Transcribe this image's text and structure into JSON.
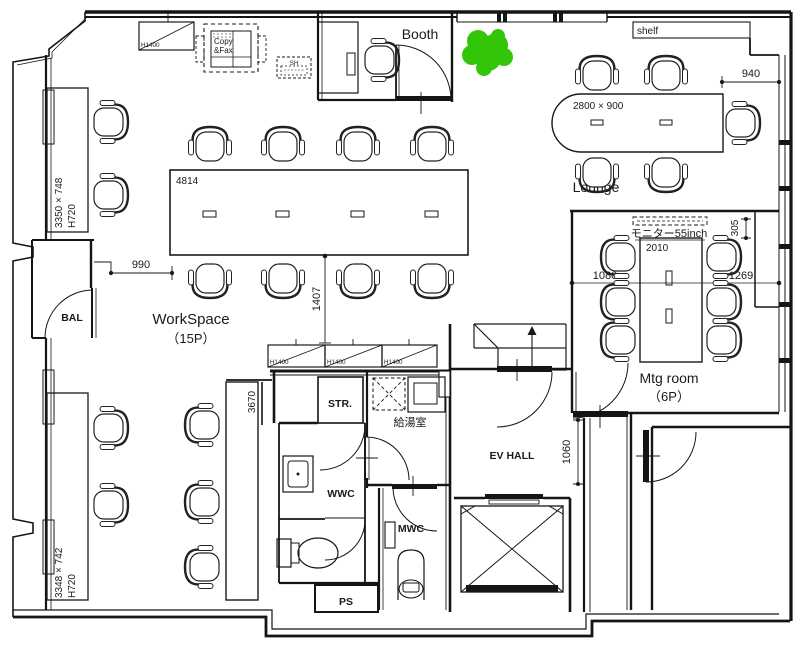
{
  "plan": {
    "rooms": {
      "booth": "Booth",
      "lounge": "Lounge",
      "workspace_line1": "WorkSpace",
      "workspace_line2": "（15P）",
      "mtg_line1": "Mtg room",
      "mtg_line2": "（6P）",
      "bal": "BAL",
      "str": "STR.",
      "kitchen": "給湯室",
      "wwc": "WWC",
      "mwc": "MWC",
      "ps": "PS",
      "ev_hall": "EV HALL"
    },
    "fixtures": {
      "shelf": "shelf",
      "copy_fax_line1": "Copy",
      "copy_fax_line2": "&Fax",
      "sh": "SH",
      "cabinet_height": "H1400",
      "monitor": "モニター55inch",
      "lounge_table_size": "2800 × 900",
      "workspace_table_size": "4814",
      "mtg_table_size": "2010",
      "counter_top_size": "3350 × 748",
      "counter_top_height": "H720",
      "counter_bottom_size": "3348 × 742",
      "counter_bottom_height": "H720"
    },
    "dimensions": {
      "d940": "940",
      "d990": "990",
      "d1407": "1407",
      "d1080": "1080",
      "d1269": "1269",
      "d305": "305",
      "d1060": "1060",
      "d3670": "3670"
    },
    "colors": {
      "line": "#1a1a1a",
      "plant": "#33c608",
      "background": "#ffffff"
    }
  }
}
